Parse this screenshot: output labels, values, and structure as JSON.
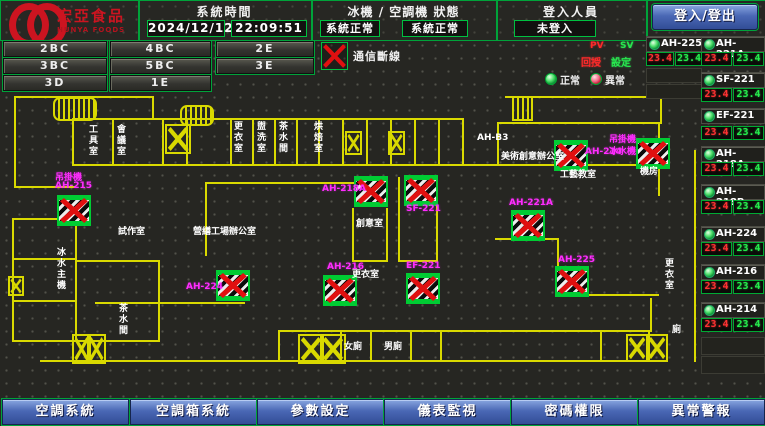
{
  "header": {
    "logo": {
      "title": "宏亞食品",
      "subtitle": "HUNYA FOODS"
    },
    "system_time": {
      "label": "系統時間",
      "date": "2024/12/12",
      "time": "22:09:51"
    },
    "status": {
      "label": "冰機 / 空調機 狀態",
      "chiller": "系統正常",
      "ahu": "系統正常"
    },
    "login": {
      "label": "登入人員",
      "value": "未登入",
      "button": "登入/登出"
    }
  },
  "floors": {
    "rows": [
      [
        "2BC",
        "4BC",
        "2E"
      ],
      [
        "3BC",
        "5BC",
        "3E"
      ],
      [
        "3D",
        "1E"
      ]
    ]
  },
  "legend": {
    "comm_loss": "通信斷線",
    "pv": "PV",
    "sv": "SV",
    "pv_cn": "回授",
    "sv_cn": "設定",
    "normal": "正常",
    "abnormal": "異常"
  },
  "units": {
    "colA": [
      {
        "name": "AH-225",
        "pv": "23.4",
        "sv": "23.4"
      }
    ],
    "colB": [
      {
        "name": "AH-221A",
        "pv": "23.4",
        "sv": "23.4"
      },
      {
        "name": "SF-221",
        "pv": "23.4",
        "sv": "23.4"
      },
      {
        "name": "EF-221",
        "pv": "23.4",
        "sv": "23.4"
      },
      {
        "name": "AH-218A",
        "pv": "23.4",
        "sv": "23.4"
      },
      {
        "name": "AH-218B",
        "pv": "23.4",
        "sv": "23.4"
      },
      {
        "name": "AH-224",
        "pv": "23.4",
        "sv": "23.4"
      },
      {
        "name": "AH-216",
        "pv": "23.4",
        "sv": "23.4"
      },
      {
        "name": "AH-214",
        "pv": "23.4",
        "sv": "23.4"
      }
    ],
    "empty_slots": {
      "colA": 2,
      "colB": 2
    }
  },
  "plan": {
    "equipment": [
      {
        "id": "AH-215",
        "icon": [
          57,
          195
        ],
        "labels": [
          {
            "t": "吊掛機",
            "x": 55,
            "y": 170
          },
          {
            "t": "AH-215",
            "x": 55,
            "y": 181
          }
        ]
      },
      {
        "id": "AH-224",
        "icon": [
          216,
          270
        ],
        "labels": [
          {
            "t": "AH-224",
            "x": 186,
            "y": 282
          }
        ]
      },
      {
        "id": "AH-216",
        "icon": [
          323,
          275
        ],
        "labels": [
          {
            "t": "AH-216",
            "x": 327,
            "y": 262
          }
        ]
      },
      {
        "id": "EF-221",
        "icon": [
          406,
          273
        ],
        "labels": [
          {
            "t": "EF-221",
            "x": 406,
            "y": 261
          }
        ]
      },
      {
        "id": "AH-218A",
        "icon": [
          354,
          176
        ],
        "labels": [
          {
            "t": "AH-218A",
            "x": 322,
            "y": 184
          }
        ]
      },
      {
        "id": "SF-221",
        "icon": [
          404,
          175
        ],
        "labels": [
          {
            "t": "SF-221",
            "x": 406,
            "y": 204
          }
        ]
      },
      {
        "id": "AH-221A",
        "icon": [
          511,
          210
        ],
        "labels": [
          {
            "t": "AH-221A",
            "x": 509,
            "y": 198
          }
        ]
      },
      {
        "id": "AH-225",
        "icon": [
          555,
          266
        ],
        "labels": [
          {
            "t": "AH-225",
            "x": 558,
            "y": 255
          }
        ]
      },
      {
        "id": "AH-214",
        "icon": [
          554,
          140
        ],
        "labels": [
          {
            "t": "AH-214",
            "x": 585,
            "y": 147
          }
        ]
      },
      {
        "id": "吊掛機",
        "icon": [
          636,
          138
        ],
        "labels": [
          {
            "t": "吊掛機",
            "x": 609,
            "y": 132
          },
          {
            "t": "冰水機",
            "x": 609,
            "y": 144
          }
        ]
      }
    ],
    "rooms": [
      {
        "t": "工具室",
        "x": 86,
        "y": 124,
        "vert": true
      },
      {
        "t": "會議室",
        "x": 114,
        "y": 124,
        "vert": true
      },
      {
        "t": "更衣室",
        "x": 231,
        "y": 121,
        "vert": true
      },
      {
        "t": "盥洗室",
        "x": 254,
        "y": 121,
        "vert": true
      },
      {
        "t": "茶水間",
        "x": 276,
        "y": 121,
        "vert": true
      },
      {
        "t": "烘焙室",
        "x": 311,
        "y": 121,
        "vert": true
      },
      {
        "t": "試作室",
        "x": 118,
        "y": 224
      },
      {
        "t": "營繕工場辦公室",
        "x": 193,
        "y": 224
      },
      {
        "t": "AH-B3",
        "x": 477,
        "y": 133
      },
      {
        "t": "美術創意辦公室",
        "x": 501,
        "y": 149
      },
      {
        "t": "工藝教室",
        "x": 560,
        "y": 167
      },
      {
        "t": "機房",
        "x": 640,
        "y": 164
      },
      {
        "t": "創意室",
        "x": 356,
        "y": 216
      },
      {
        "t": "更衣室",
        "x": 352,
        "y": 267
      },
      {
        "t": "冰水主機",
        "x": 54,
        "y": 247,
        "vert": true
      },
      {
        "t": "茶水間",
        "x": 116,
        "y": 303,
        "vert": true
      },
      {
        "t": "女廁",
        "x": 344,
        "y": 339
      },
      {
        "t": "男廁",
        "x": 384,
        "y": 339
      },
      {
        "t": "更衣室",
        "x": 662,
        "y": 258,
        "vert": true
      },
      {
        "t": "廁",
        "x": 672,
        "y": 322
      }
    ]
  },
  "bottom_nav": [
    {
      "id": "ac-system",
      "label": "空調系統"
    },
    {
      "id": "ahu-system",
      "label": "空調箱系統"
    },
    {
      "id": "param-settings",
      "label": "參數設定"
    },
    {
      "id": "meter-monitor",
      "label": "儀表監視"
    },
    {
      "id": "password-auth",
      "label": "密碼權限"
    },
    {
      "id": "alarm",
      "label": "異常警報"
    }
  ]
}
